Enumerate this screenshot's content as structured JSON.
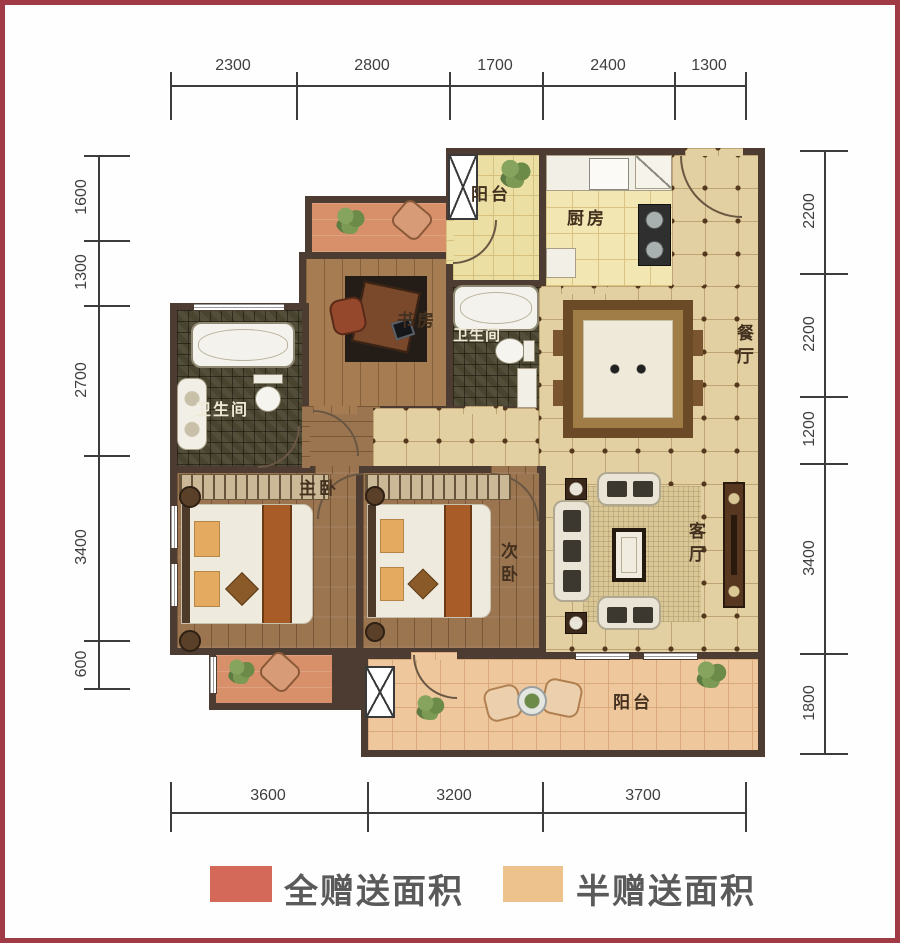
{
  "plan": {
    "rooms": {
      "balcony_top": {
        "label": "阳台"
      },
      "kitchen": {
        "label": "厨房"
      },
      "study": {
        "label": "书房"
      },
      "bath_middle": {
        "label": "卫生间"
      },
      "bath_left": {
        "label": "卫生间"
      },
      "dining": {
        "label": "餐厅"
      },
      "living": {
        "label": "客厅"
      },
      "master_bedroom": {
        "label": "主卧"
      },
      "second_bedroom": {
        "label": "次卧"
      },
      "balcony_bottom": {
        "label": "阳台"
      }
    }
  },
  "dimensions": {
    "top": [
      "2300",
      "2800",
      "1700",
      "2400",
      "1300"
    ],
    "bottom": [
      "3600",
      "3200",
      "3700"
    ],
    "left": [
      "1600",
      "1300",
      "2700",
      "3400",
      "600"
    ],
    "right": [
      "2200",
      "2200",
      "1200",
      "3400",
      "1800"
    ]
  },
  "legend": {
    "items": [
      {
        "label": "全赠送面积",
        "color": "#d4695a"
      },
      {
        "label": "半赠送面积",
        "color": "#edc28c"
      }
    ]
  },
  "colors": {
    "frame_border": "#a03b45",
    "wall": "#4d3c32",
    "tile_floor": "#e3d0a2",
    "wood_floor": "#9b7450"
  }
}
